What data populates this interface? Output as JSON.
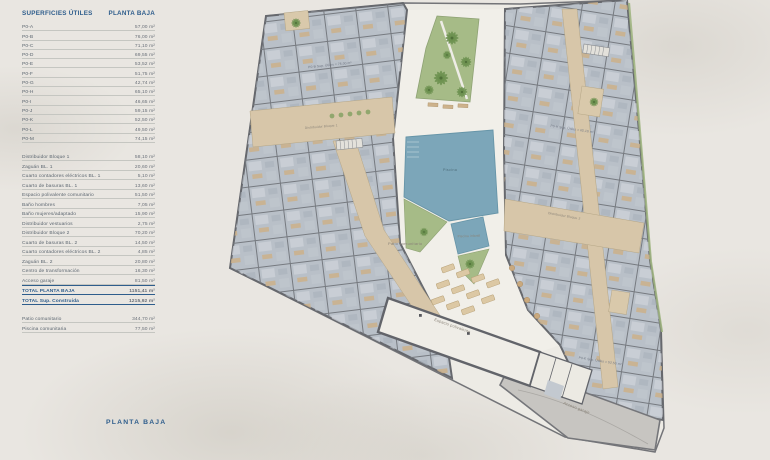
{
  "panel": {
    "title_left": "SUPERFICIES ÚTILES",
    "title_right": "PLANTA BAJA",
    "units": [
      {
        "label": "P0-A",
        "value": "57,00 m²"
      },
      {
        "label": "P0-B",
        "value": "76,00 m²"
      },
      {
        "label": "P0-C",
        "value": "71,10 m²"
      },
      {
        "label": "P0-D",
        "value": "69,55 m²"
      },
      {
        "label": "P0-E",
        "value": "53,52 m²"
      },
      {
        "label": "P0-F",
        "value": "51,75 m²"
      },
      {
        "label": "P0-G",
        "value": "42,74 m²"
      },
      {
        "label": "P0-H",
        "value": "65,10 m²"
      },
      {
        "label": "P0-I",
        "value": "46,65 m²"
      },
      {
        "label": "P0-J",
        "value": "59,15 m²"
      },
      {
        "label": "P0-K",
        "value": "52,50 m²"
      },
      {
        "label": "P0-L",
        "value": "49,50 m²"
      },
      {
        "label": "P0-M",
        "value": "74,15 m²"
      }
    ],
    "common": [
      {
        "label": "Distribuidor Bloque 1",
        "value": "58,10 m²"
      },
      {
        "label": "Zaguán BL. 1",
        "value": "20,60 m²"
      },
      {
        "label": "Cuarto contadores eléctricos BL. 1",
        "value": "5,10 m²"
      },
      {
        "label": "Cuarto de basuras BL. 1",
        "value": "13,60 m²"
      },
      {
        "label": "Espacio polivalente comunitario",
        "value": "51,50 m²"
      },
      {
        "label": "Baño hombres",
        "value": "7,05 m²"
      },
      {
        "label": "Baño mujeres/adaptado",
        "value": "15,90 m²"
      },
      {
        "label": "Distribuidor vestuarios",
        "value": "2,75 m²"
      },
      {
        "label": "Distribuidor Bloque 2",
        "value": "70,20 m²"
      },
      {
        "label": "Cuarto de basuras BL. 2",
        "value": "14,50 m²"
      },
      {
        "label": "Cuarto contadores eléctricos BL. 2",
        "value": "4,85 m²"
      },
      {
        "label": "Zaguán BL. 2",
        "value": "20,80 m²"
      },
      {
        "label": "Centro de transformación",
        "value": "16,30 m²"
      },
      {
        "label": "Acceso garaje",
        "value": "81,50 m²"
      }
    ],
    "totals": [
      {
        "label": "TOTAL PLANTA BAJA",
        "value": "1151,41 m²"
      },
      {
        "label": "TOTAL Sup. Construida",
        "value": "1215,92 m²"
      }
    ],
    "extras": [
      {
        "label": "Patio comunitario",
        "value": "344,70 m²"
      },
      {
        "label": "Piscina comunitaria",
        "value": "77,50 m²"
      }
    ]
  },
  "footer": {
    "title": "PLANTA BAJA"
  },
  "plan": {
    "labels": {
      "patio": "Patio comunitario",
      "piscina": "Piscina",
      "piscina_infantil": "Piscina infantil",
      "espacio": "Espacio polivalente",
      "acceso": "Acceso garaje",
      "distribuidor1": "Distribuidor Bloque 1",
      "distribuidor2": "Distribuidor Bloque 2"
    },
    "unit_labels": {
      "b": "P0-B Sup. Útiles = 76,00 m²",
      "h": "P0-H Sup. Útiles = 65,10 m²",
      "k": "P0-K Sup. Útiles = 52,50 m²"
    }
  },
  "colors": {
    "accent_blue": "#2e5d8c",
    "pool": "#7ca6b9",
    "garden": "#a6bb87",
    "corridor": "#d7c6a9",
    "apartments": "#b9c0c8",
    "walls": "#66686d",
    "background": "#e9e6e1"
  }
}
